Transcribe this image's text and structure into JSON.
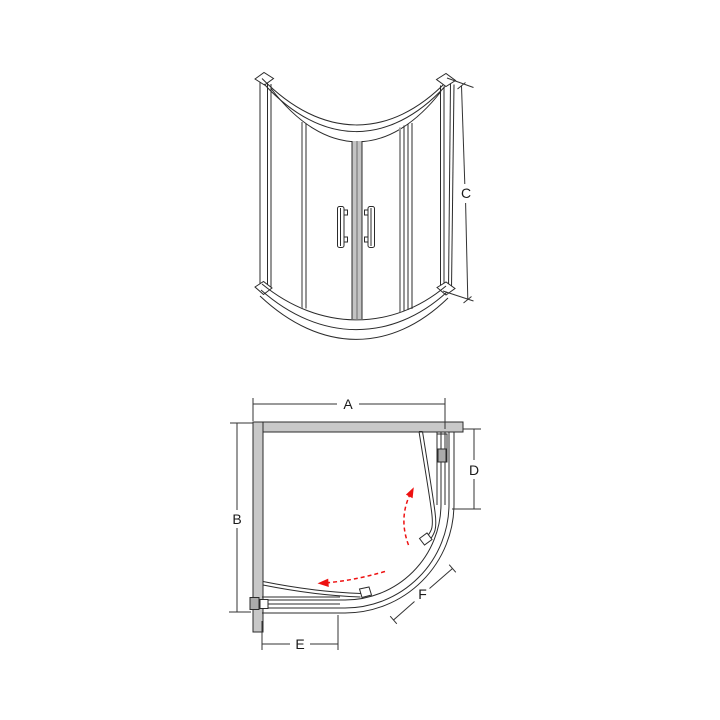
{
  "diagram": {
    "type": "technical-dimension-diagram",
    "subject": "quadrant sliding-door shower enclosure",
    "views": [
      {
        "id": "front-elevation",
        "dimension_labels": [
          "C"
        ]
      },
      {
        "id": "plan-view",
        "dimension_labels": [
          "A",
          "B",
          "D",
          "E",
          "F"
        ]
      }
    ]
  },
  "dimensions": {
    "a": "A",
    "b": "B",
    "c": "C",
    "d": "D",
    "e": "E",
    "f": "F"
  },
  "colors": {
    "line": "#2b2b2b",
    "dimension": "#333333",
    "wall-fill": "#c8c8c8",
    "bracket-fill": "#ababab",
    "stile-fill": "#c3c3c3",
    "arrow-red": "#ee1111",
    "background": "#ffffff"
  }
}
